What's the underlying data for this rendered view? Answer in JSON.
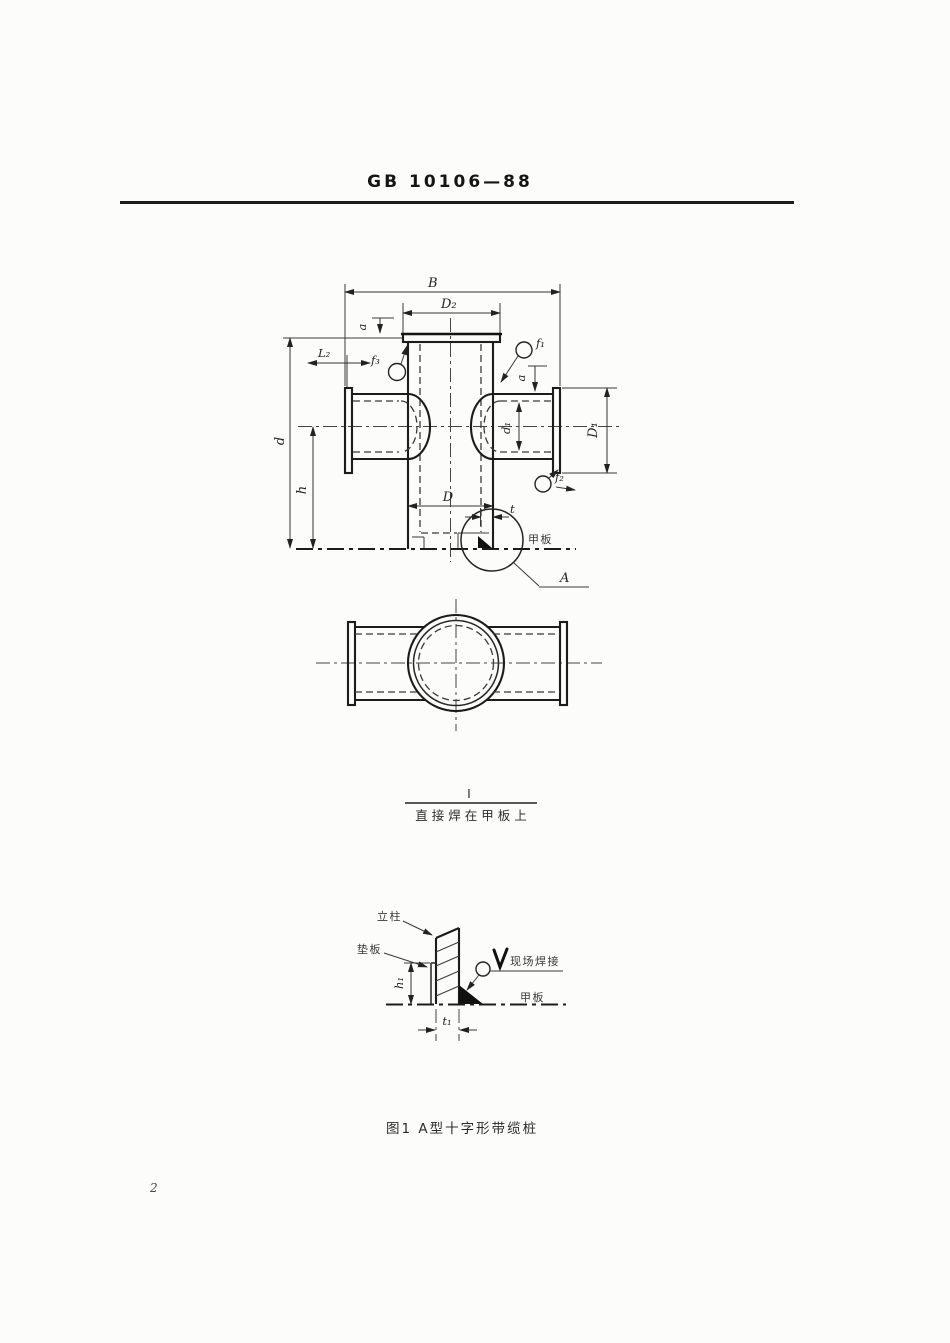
{
  "colors": {
    "ink": "#1d1d1d",
    "paper": "#fcfcfa"
  },
  "header": {
    "standard_number": "GB 10106—88"
  },
  "front_view": {
    "dim_labels": {
      "B": "B",
      "D2": "D₂",
      "a_left": "a",
      "L2": "L₂",
      "f3": "f₃",
      "f1": "f₁",
      "a_right": "a",
      "d1": "d₁",
      "D1": "D₁",
      "f2": "f₂",
      "d": "d",
      "h": "h",
      "D": "D",
      "t": "t"
    },
    "deck_label": "甲板",
    "detail_ref": "A"
  },
  "variant_note": {
    "numerator": "Ⅰ",
    "denominator": "直接焊在甲板上"
  },
  "detail_view": {
    "labels": {
      "column": "立柱",
      "pad": "垫板",
      "weld_note": "现场焊接",
      "deck": "甲板"
    },
    "dim_labels": {
      "h1": "h₁",
      "t1": "t₁"
    }
  },
  "caption": {
    "figure": "图1  A型十字形带缆桩"
  },
  "footer": {
    "page_number": "2"
  }
}
